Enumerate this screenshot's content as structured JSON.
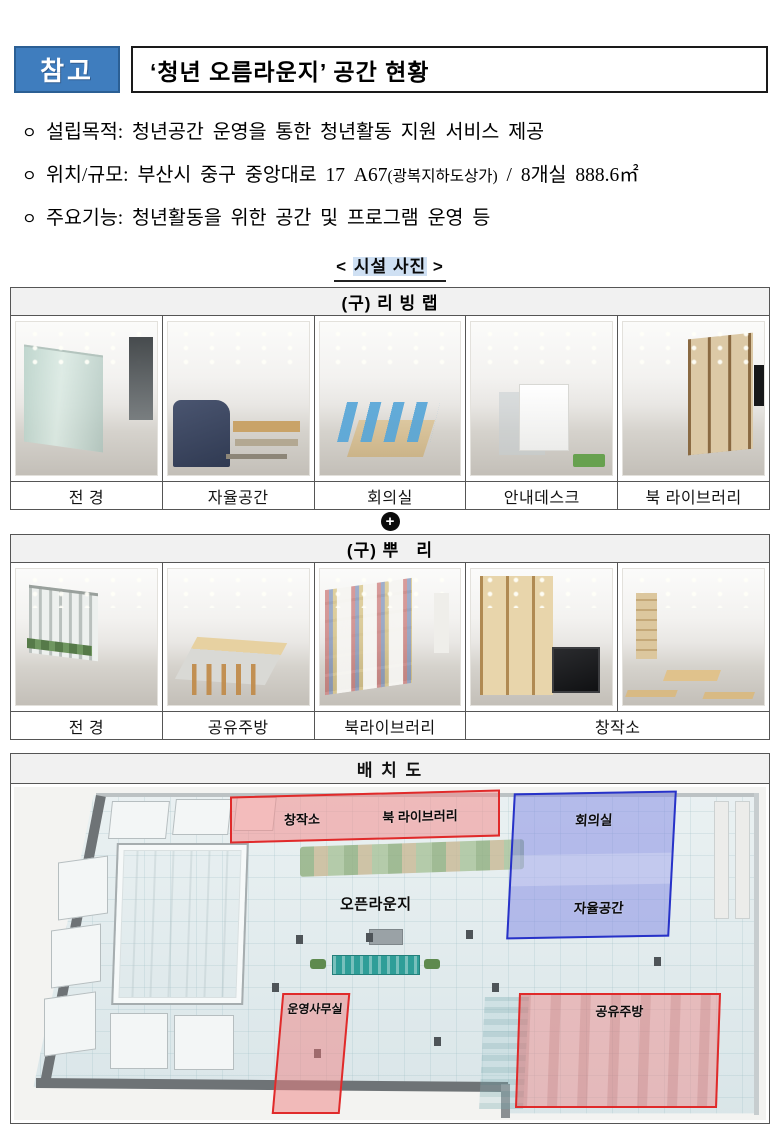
{
  "header": {
    "badge": "참고",
    "title": "‘청년 오름라운지’  공간 현황"
  },
  "bullets": [
    {
      "marker": "ㅇ",
      "pre": "설립목적: 청년공간 운영을 통한 청년활동 지원 서비스 제공"
    },
    {
      "marker": "ㅇ",
      "pre": "위치/규모: 부산시 중구 중앙대로 17 A67",
      "small": "(광복지하도상가)",
      "post": " / 8개실 888.6㎡"
    },
    {
      "marker": "ㅇ",
      "pre": "주요기능: 청년활동을 위한 공간 및 프로그램 운영 등"
    }
  ],
  "section": {
    "open": "<",
    "label": "시설 사진",
    "close": ">"
  },
  "plus": "+",
  "tables": [
    {
      "header": "(구) 리 빙 랩",
      "captions": [
        "전 경",
        "자율공간",
        "회의실",
        "안내데스크",
        "북 라이브러리"
      ]
    },
    {
      "header": "(구) 뿌   리",
      "captions": [
        "전 경",
        "공유주방",
        "북라이브러리",
        "창작소"
      ]
    }
  ],
  "floor_plan": {
    "header": "배 치 도",
    "zones": [
      {
        "id": "creative-studio",
        "label": "창작소",
        "color": "#E02A2A"
      },
      {
        "id": "book-library",
        "label": "북 라이브러리",
        "color": "#E02A2A"
      },
      {
        "id": "meeting-room",
        "label": "회의실",
        "color": "#2732C8"
      },
      {
        "id": "free-space",
        "label": "자율공간",
        "color": "#2732C8"
      },
      {
        "id": "open-lounge",
        "label": "오픈라운지",
        "color": "none"
      },
      {
        "id": "operations-office",
        "label": "운영사무실",
        "color": "#E02A2A"
      },
      {
        "id": "shared-kitchen",
        "label": "공유주방",
        "color": "#E02A2A"
      }
    ]
  },
  "colors": {
    "badge_blue": "#3F7DBE",
    "section_highlight": "#CFE0F3",
    "table_header_bg": "#F1F1F1",
    "zone_red": "#E02A2A",
    "zone_blue": "#2732C8"
  }
}
